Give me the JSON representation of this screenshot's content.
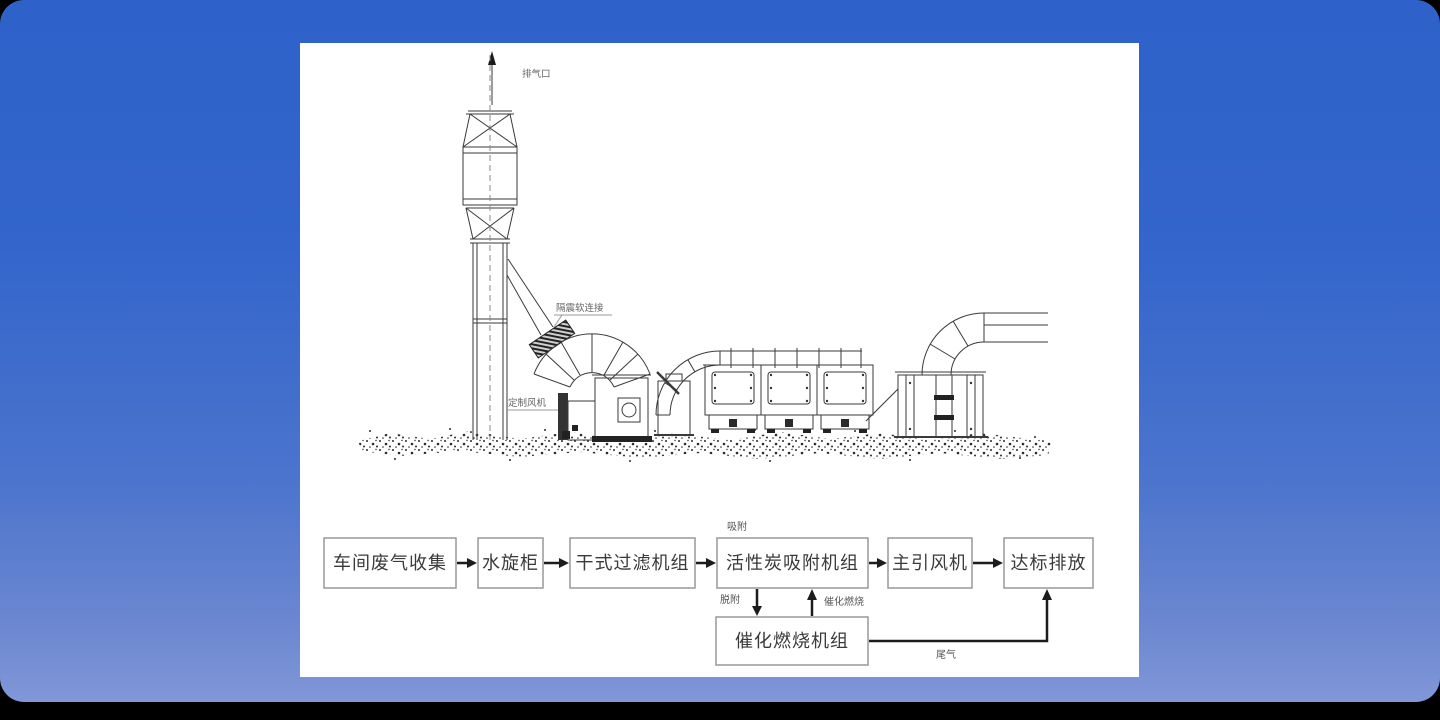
{
  "background": {
    "gradient_top": "#2e62ca",
    "gradient_bottom": "#8097d8",
    "panel_bg": "#ffffff"
  },
  "diagram": {
    "line_color": "#3a3a3a",
    "labels": {
      "exhaust_outlet": "排气口",
      "flex_connection": "隔震软连接",
      "custom_fan": "定制风机"
    }
  },
  "flowchart": {
    "box_border_color": "#999999",
    "text_color": "#3a3a3a",
    "arrow_color": "#1c1c1c",
    "boxes": [
      {
        "id": "workshop-gas-collection",
        "label": "车间废气收集"
      },
      {
        "id": "water-spray-cabinet",
        "label": "水旋柜"
      },
      {
        "id": "dry-filter-unit",
        "label": "干式过滤机组"
      },
      {
        "id": "carbon-adsorption-unit",
        "label": "活性炭吸附机组"
      },
      {
        "id": "main-draft-fan",
        "label": "主引风机"
      },
      {
        "id": "compliant-discharge",
        "label": "达标排放"
      },
      {
        "id": "catalytic-combustion-unit",
        "label": "催化燃烧机组"
      }
    ],
    "edge_labels": {
      "adsorb": "吸附",
      "desorb": "脱附",
      "catalytic_combustion": "催化燃烧",
      "tail_gas": "尾气"
    }
  }
}
